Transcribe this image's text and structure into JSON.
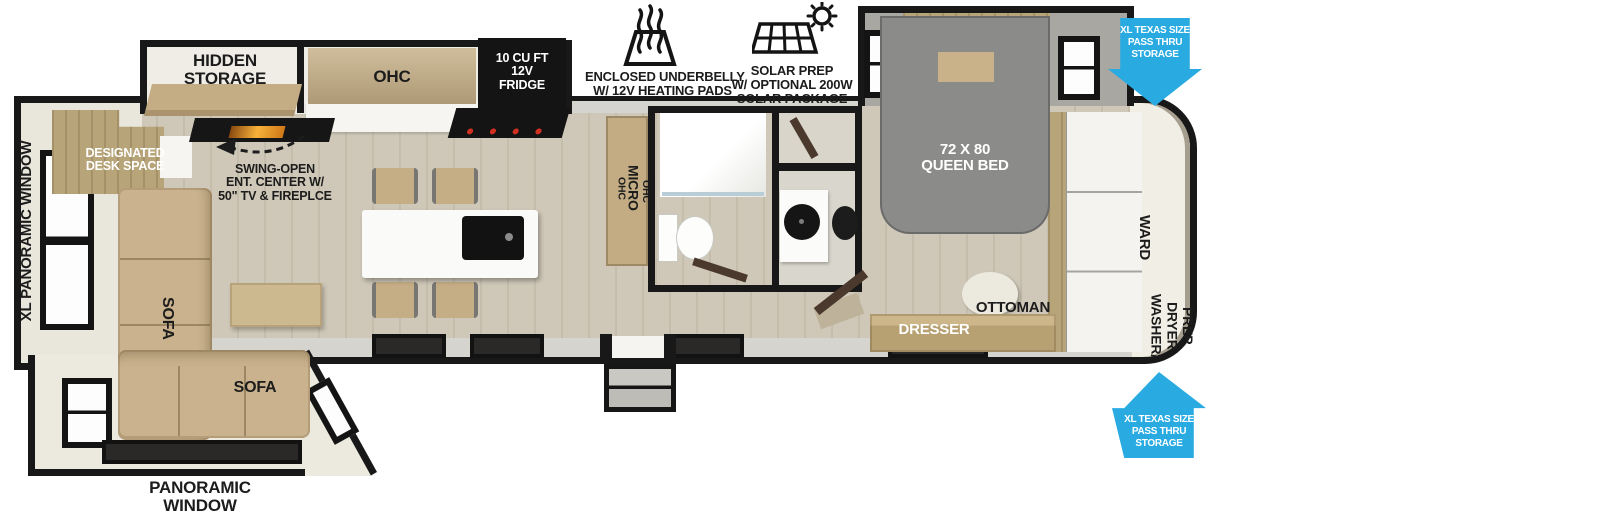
{
  "colors": {
    "accent_blue": "#29abe2",
    "wall_black": "#181818",
    "floor_tan": "#cfc8b8",
    "furniture_tan": "#c9b28d",
    "bed_gray": "#8b8b89",
    "ivory": "#eceadf"
  },
  "callouts": {
    "underbelly": {
      "icon": "heating-pads-icon",
      "line1": "ENCLOSED UNDERBELLY",
      "line2": "W/ 12V HEATING PADS"
    },
    "solar": {
      "icon": "solar-panel-icon",
      "line1": "SOLAR PREP",
      "line2": "W/ OPTIONAL 200W",
      "line3": "SOLAR PACKAGE"
    },
    "pass_thru_front": {
      "line1": "XL TEXAS SIZE",
      "line2": "PASS THRU",
      "line3": "STORAGE"
    },
    "pass_thru_rear": {
      "line1": "XL TEXAS SIZE",
      "line2": "PASS THRU",
      "line3": "STORAGE"
    }
  },
  "living": {
    "xl_panoramic_window": "XL PANORAMIC WINDOW",
    "panoramic_window_line1": "PANORAMIC",
    "panoramic_window_line2": "WINDOW",
    "hidden_storage_line1": "HIDDEN",
    "hidden_storage_line2": "STORAGE",
    "desk_line1": "DESIGNATED",
    "desk_line2": "DESK SPACE",
    "ent_line1": "SWING-OPEN",
    "ent_line2": "ENT. CENTER W/",
    "ent_line3": "50\" TV & FIREPLCE",
    "sofa_chaise": "SOFA",
    "sofa_main": "SOFA"
  },
  "kitchen": {
    "ohc": "OHC",
    "fridge_line1": "10 CU FT",
    "fridge_line2": "12V",
    "fridge_line3": "FRIDGE",
    "cab_top": "OHC",
    "cab_mid": "MICRO",
    "cab_bottom": "OHC"
  },
  "bedroom": {
    "bed_line1": "72 X 80",
    "bed_line2": "QUEEN BED",
    "ottoman": "OTTOMAN",
    "dresser": "DRESSER",
    "wardrobe": "WARD",
    "washer_line1": "WASHER/",
    "washer_line2": "DRYER",
    "washer_line3": "PREP"
  }
}
